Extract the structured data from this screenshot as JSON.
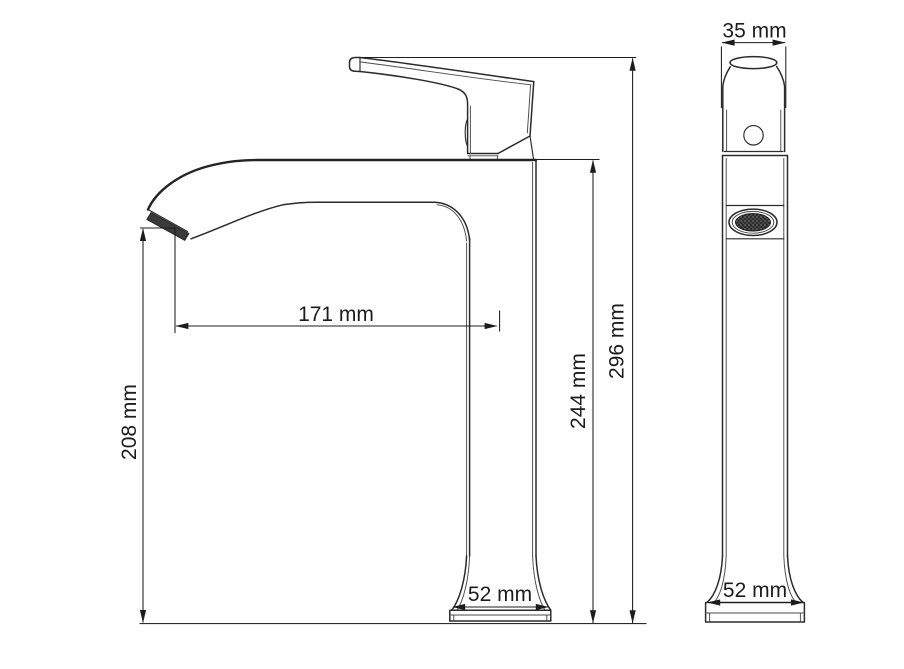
{
  "drawing": {
    "colors": {
      "background": "#ffffff",
      "line": "#2b2b2b",
      "dimension": "#1c1c1c",
      "aerator_fill": "#3a3a3a"
    },
    "dimensions": {
      "handle_width": "35 mm",
      "spout_reach": "171 mm",
      "spout_height": "208 mm",
      "body_height": "244 mm",
      "total_height": "296 mm",
      "base_width_side": "52 mm",
      "base_width_front": "52 mm"
    }
  }
}
